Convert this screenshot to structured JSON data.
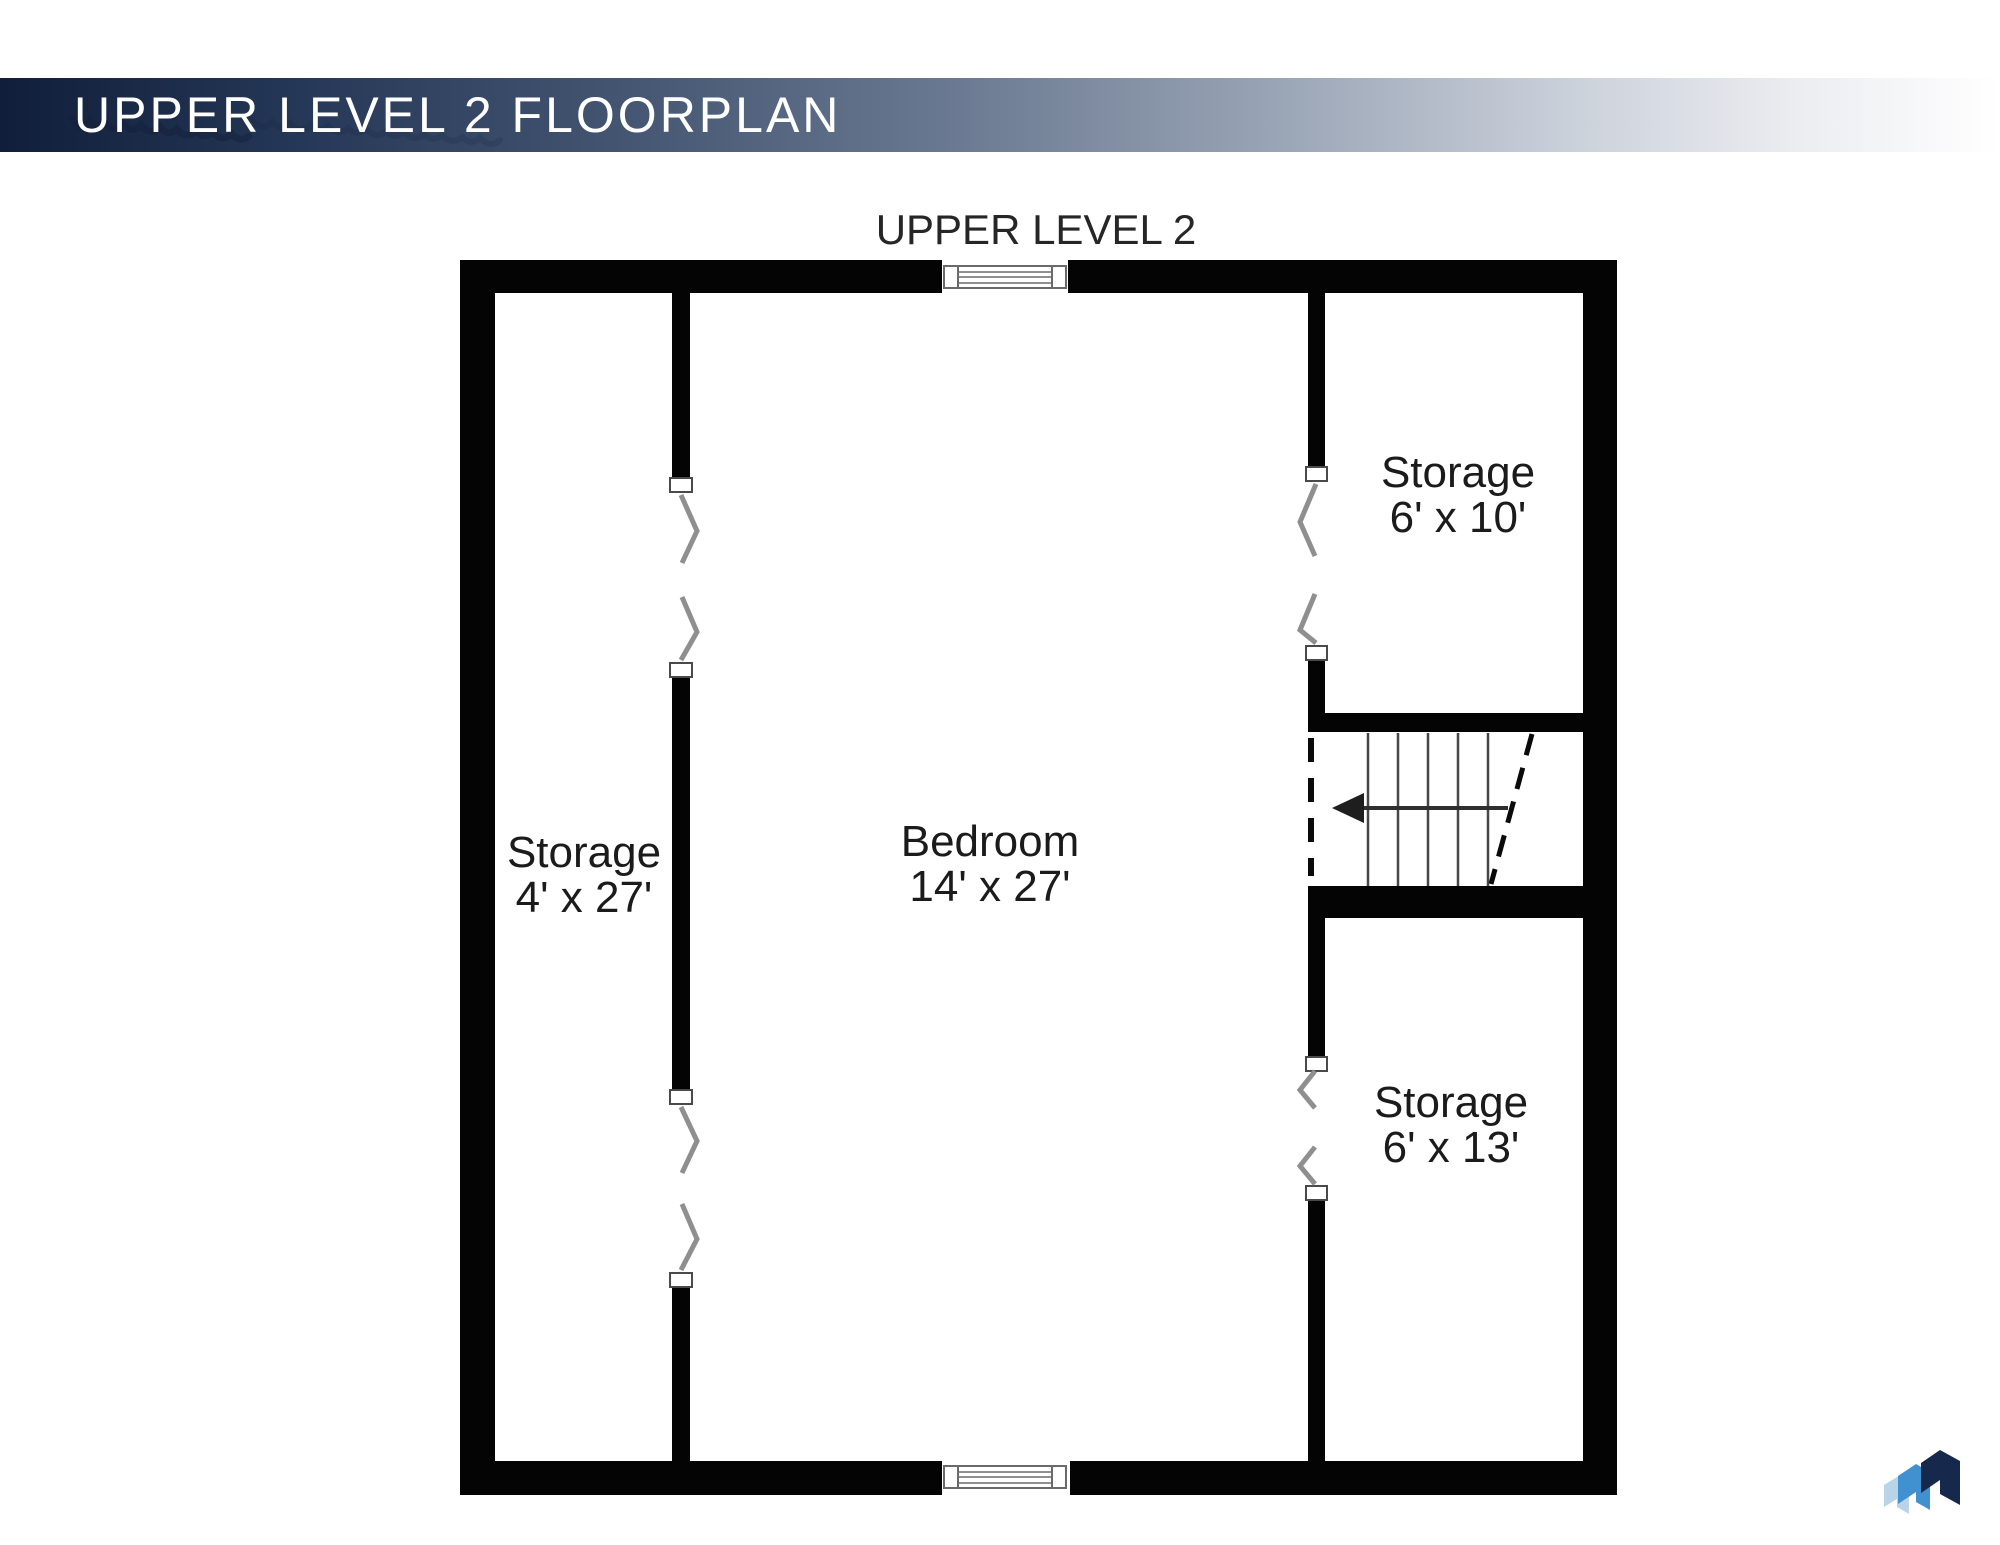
{
  "header": {
    "title": "UPPER LEVEL 2 FLOORPLAN"
  },
  "plan": {
    "level_label": "UPPER LEVEL 2",
    "rooms": [
      {
        "id": "storage-left",
        "name": "Storage",
        "dimensions": "4' x 27'"
      },
      {
        "id": "bedroom",
        "name": "Bedroom",
        "dimensions": "14' x 27'"
      },
      {
        "id": "storage-top-right",
        "name": "Storage",
        "dimensions": "6' x 10'"
      },
      {
        "id": "storage-bottom-right",
        "name": "Storage",
        "dimensions": "6' x 13'"
      }
    ],
    "stairs": {
      "direction_arrow": "left"
    }
  },
  "icons": {
    "logo": "brand-logo-triple-chevron"
  },
  "colors": {
    "wall": "#040404",
    "header_gradient_start": "#101e3a",
    "header_gradient_end": "#ffffff",
    "logo_dark": "#16294d",
    "logo_mid": "#4191d0",
    "logo_light": "#b9d4e6"
  }
}
